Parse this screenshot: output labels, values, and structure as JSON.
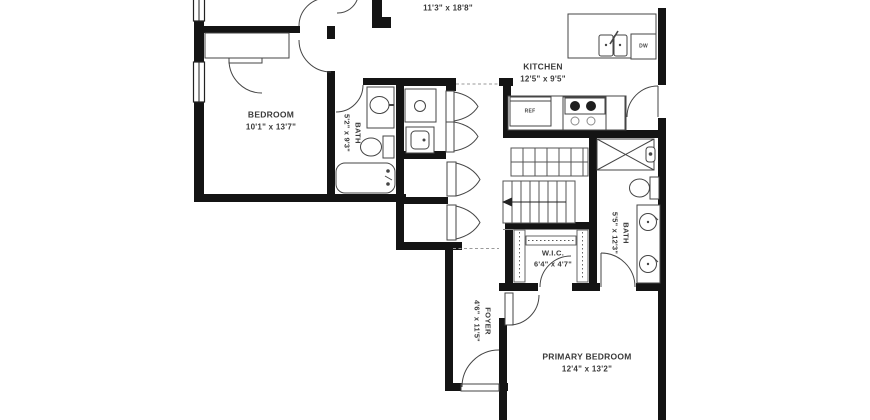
{
  "plan": {
    "title": "apartment-floor-plan",
    "rooms": {
      "living": {
        "dims": "11'3\" x 18'8\""
      },
      "kitchen": {
        "name": "KITCHEN",
        "dims": "12'5\" x 9'5\""
      },
      "bedroom": {
        "name": "BEDROOM",
        "dims": "10'1\" x 13'7\""
      },
      "bath1": {
        "name": "BATH",
        "dims": "5'2\" x 9'3\""
      },
      "bath2": {
        "name": "BATH",
        "dims": "5'5\" x 12'3\""
      },
      "wic": {
        "name": "W.I.C.",
        "dims": "6'4\" x 4'7\""
      },
      "foyer": {
        "name": "FOYER",
        "dims": "4'6\" x 11'5\""
      },
      "primary": {
        "name": "PRIMARY BEDROOM",
        "dims": "12'4\" x 13'2\""
      }
    },
    "appliances": {
      "refrigerator": "REF",
      "dishwasher": "DW"
    },
    "colors": {
      "wall": "#141414",
      "fixture_line": "#454545",
      "text": "#3a3a3a",
      "background": "#ffffff"
    }
  }
}
